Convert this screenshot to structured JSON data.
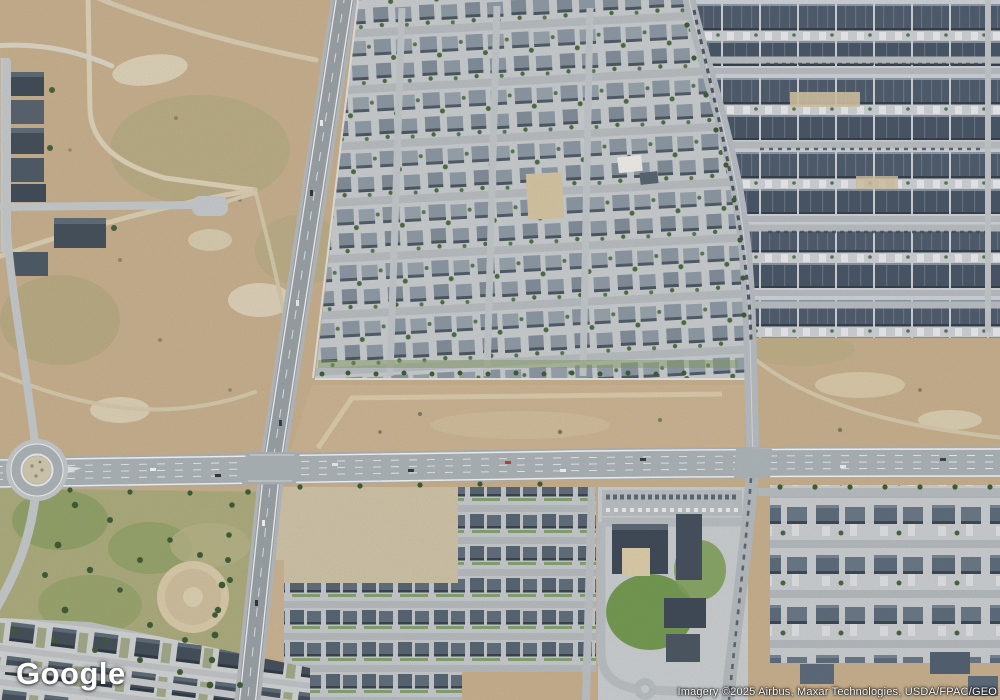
{
  "view": {
    "type": "satellite-map",
    "description": "Aerial imagery of suburban development: desert vacant lots, residential subdivisions, townhome rows, an east-west arterial road with a roundabout and two signalized intersections, a park with a dirt ball field, and an apartment/school campus."
  },
  "overlay": {
    "logo_text": "Google",
    "imagery_credit": "Imagery ©2025 Airbus, Maxar Technologies, USDA/FPAC/GEO"
  },
  "features": [
    "vacant desert land (northwest)",
    "north-south highway",
    "east-west arterial road",
    "roundabout (southwest)",
    "dense single-family subdivision (north-center)",
    "townhome rows (northeast)",
    "curving collector road",
    "park with dirt ball field (southwest)",
    "apartment and school campus (south-center)",
    "single-family rows (southeast)"
  ],
  "colors": {
    "desert_tan": "#c4ad8b",
    "desert_light": "#dbd0b6",
    "desert_olive": "#a8a678",
    "dirt_lot": "#d2c5a6",
    "asphalt_arterial": "#a9b0b4",
    "asphalt_highway": "#979ea3",
    "street": "#b5bac0",
    "residential_ground": "#c6cacc",
    "roof_medium": "#8995a1",
    "roof_dark": "#4d5a6b",
    "roof_charcoal": "#414d59",
    "lane_line_white": "#f2f4f5",
    "grass_green": "#719750",
    "park_olive": "#a9a97b",
    "tree_green": "#3c5a33"
  }
}
